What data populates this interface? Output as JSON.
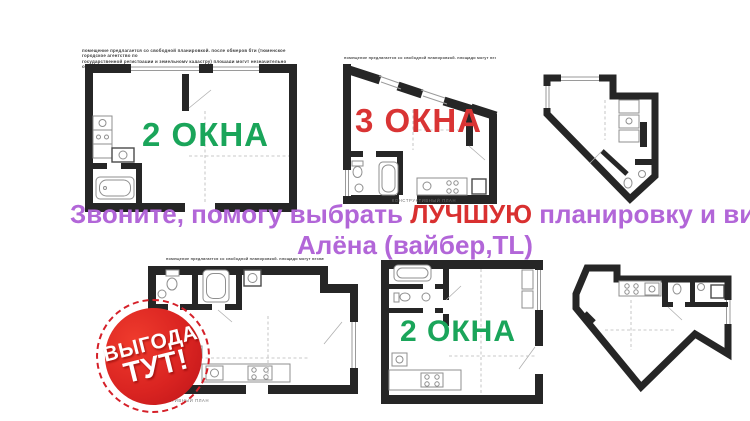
{
  "headline": {
    "part1": "Звоните, помогу выбрать ",
    "highlight": "ЛУЧШУЮ",
    "part2": " планировку и вид!",
    "line2": "Алёна (вайбер,TL)"
  },
  "plan_labels": {
    "plan1": "2 ОКНА",
    "plan2": "3 ОКНА",
    "plan5": "2 ОКНА"
  },
  "badge": {
    "line1": "ВЫГОДА",
    "line2": "ТУТ!"
  },
  "disclaimers": {
    "plan1_line1": "помещение предлагается со свободной планировкой. после обмеров бти (тюменское городское агентство по",
    "plan1_line2": "государственной регистрации и земельному кадастру) площади могут незначительно отличаться от проектных.",
    "plan2": "помещение предлагается со свободной планировкой. площади могут незначительно отличаться от проектных.",
    "plan4": "помещение предлагается со свободной планировкой. площади могут незначительно отличаться от проектных."
  },
  "captions": {
    "plan2": "конструктивный план",
    "plan4": "конструктивный план"
  },
  "colors": {
    "green": "#1aa55a",
    "red": "#d93434",
    "purple": "#b266d8",
    "badge_red": "#d52029",
    "wall": "#262626"
  }
}
